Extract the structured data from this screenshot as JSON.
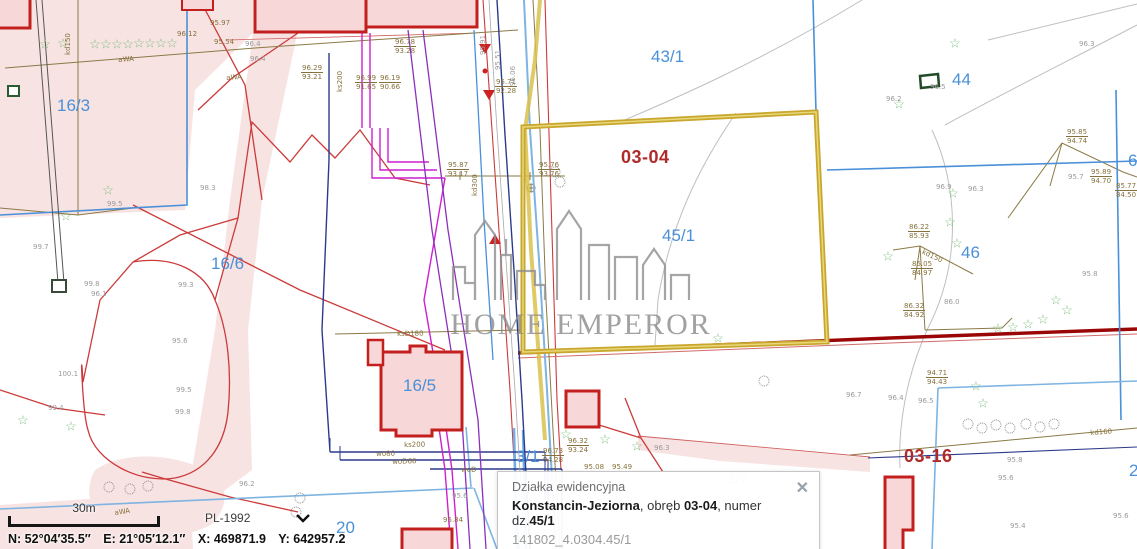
{
  "watermark": {
    "text": "HOME EMPEROR",
    "logo": "city-skyline-icon"
  },
  "selection": {
    "parcel": "45/1",
    "color": "#c9a62c"
  },
  "colors": {
    "parcel_label": "#4a90d9",
    "district_label": "#b02a2a",
    "link": "#3a6fd0"
  },
  "popup": {
    "title": "Działka ewidencyjna",
    "line_segments": [
      {
        "t": "Konstancin-Jeziorna",
        "b": true
      },
      {
        "t": ", obręb ",
        "b": false
      },
      {
        "t": "03-04",
        "b": true
      },
      {
        "t": ", numer dz.",
        "b": false
      },
      {
        "t": "45/1",
        "b": true
      }
    ],
    "id": "141802_4.0304.45/1",
    "links": [
      "Zbliż do obiektu",
      "Szczegóły (I)",
      "Inne"
    ],
    "close_icon": "✕"
  },
  "footer": {
    "scale_label": "30m",
    "crs": "PL-1992",
    "coords": {
      "n": "N: 52°04′35.5″",
      "e": "E: 21°05′12.1″",
      "x": "X: 469871.9",
      "y": "Y: 642957.2"
    }
  },
  "map": {
    "star_glyph": "☆",
    "labels": [
      {
        "t": "16/3",
        "x": 57,
        "y": 96,
        "c": "parcel"
      },
      {
        "t": "16/6",
        "x": 211,
        "y": 254,
        "c": "parcel"
      },
      {
        "t": "16/5",
        "x": 403,
        "y": 376,
        "c": "parcel"
      },
      {
        "t": "43/1",
        "x": 651,
        "y": 47,
        "c": "parcel"
      },
      {
        "t": "44",
        "x": 952,
        "y": 70,
        "c": "parcel"
      },
      {
        "t": "45/1",
        "x": 662,
        "y": 226,
        "c": "parcel"
      },
      {
        "t": "46",
        "x": 961,
        "y": 243,
        "c": "parcel"
      },
      {
        "t": "20",
        "x": 336,
        "y": 518,
        "c": "parcel"
      },
      {
        "t": "3/1",
        "x": 516,
        "y": 447,
        "c": "parcel"
      },
      {
        "t": "2/7",
        "x": 727,
        "y": 470,
        "c": "parcel-light"
      },
      {
        "t": "6",
        "x": 1128,
        "y": 151,
        "c": "parcel"
      },
      {
        "t": "2",
        "x": 1129,
        "y": 461,
        "c": "parcel"
      },
      {
        "t": "03-04",
        "x": 621,
        "y": 147,
        "c": "district"
      },
      {
        "t": "03-16",
        "x": 904,
        "y": 446,
        "c": "district"
      },
      {
        "t": "95.85",
        "t2": "94.74",
        "x": 1066,
        "y": 128,
        "c": "elev"
      },
      {
        "t": "95.89",
        "t2": "94.70",
        "x": 1090,
        "y": 168,
        "c": "elev"
      },
      {
        "t": "85.77",
        "t2": "84.50",
        "x": 1115,
        "y": 182,
        "c": "elev"
      },
      {
        "t": "86.22",
        "t2": "85.93",
        "x": 908,
        "y": 223,
        "c": "elev"
      },
      {
        "t": "85.05",
        "t2": "84.97",
        "x": 911,
        "y": 260,
        "c": "elev"
      },
      {
        "t": "86.32",
        "t2": "84.92",
        "x": 903,
        "y": 302,
        "c": "elev"
      },
      {
        "t": "95.87",
        "t2": "93.17",
        "x": 447,
        "y": 161,
        "c": "elev"
      },
      {
        "t": "95.76",
        "t2": "93.76",
        "x": 538,
        "y": 161,
        "c": "elev"
      },
      {
        "t": "95.71",
        "t2": "92.28",
        "x": 495,
        "y": 78,
        "c": "elev"
      },
      {
        "t": "96.78",
        "t2": "93.28",
        "x": 394,
        "y": 38,
        "c": "elev"
      },
      {
        "t": "96.29",
        "t2": "93.21",
        "x": 301,
        "y": 64,
        "c": "elev"
      },
      {
        "t": "96.99",
        "t2": "91.65",
        "x": 355,
        "y": 74,
        "c": "elev"
      },
      {
        "t": "96.19",
        "t2": "90.66",
        "x": 379,
        "y": 74,
        "c": "elev"
      },
      {
        "t": "96.32",
        "t2": "93.24",
        "x": 567,
        "y": 437,
        "c": "elev"
      },
      {
        "t": "96.73",
        "t2": "94.28",
        "x": 542,
        "y": 447,
        "c": "elev"
      },
      {
        "t": "94.71",
        "t2": "94.43",
        "x": 926,
        "y": 369,
        "c": "elev"
      },
      {
        "t": "96.12",
        "x": 177,
        "y": 30,
        "c": "elev"
      },
      {
        "t": "95.54",
        "x": 214,
        "y": 38,
        "c": "elev"
      },
      {
        "t": "95.97",
        "x": 210,
        "y": 19,
        "c": "elev"
      },
      {
        "t": "95.84",
        "x": 443,
        "y": 516,
        "c": "elev"
      },
      {
        "t": "95.08",
        "x": 584,
        "y": 463,
        "c": "elev"
      },
      {
        "t": "95.49",
        "x": 612,
        "y": 463,
        "c": "elev"
      },
      {
        "t": "99.7",
        "x": 33,
        "y": 243,
        "c": "pt"
      },
      {
        "t": "99.5",
        "x": 107,
        "y": 200,
        "c": "pt"
      },
      {
        "t": "98.3",
        "x": 200,
        "y": 184,
        "c": "pt"
      },
      {
        "t": "99.8",
        "x": 84,
        "y": 280,
        "c": "pt"
      },
      {
        "t": "99.3",
        "x": 178,
        "y": 281,
        "c": "pt"
      },
      {
        "t": "95.6",
        "x": 172,
        "y": 337,
        "c": "pt"
      },
      {
        "t": "100.1",
        "x": 58,
        "y": 370,
        "c": "pt"
      },
      {
        "t": "99.4",
        "x": 48,
        "y": 404,
        "c": "pt"
      },
      {
        "t": "99.5",
        "x": 176,
        "y": 386,
        "c": "pt"
      },
      {
        "t": "99.8",
        "x": 175,
        "y": 408,
        "c": "pt"
      },
      {
        "t": "96.2",
        "x": 239,
        "y": 480,
        "c": "pt"
      },
      {
        "t": "95.6",
        "x": 452,
        "y": 492,
        "c": "pt"
      },
      {
        "t": "96.4",
        "x": 245,
        "y": 40,
        "c": "pt"
      },
      {
        "t": "96.4",
        "x": 250,
        "y": 55,
        "c": "pt"
      },
      {
        "t": "96.1",
        "x": 91,
        "y": 290,
        "c": "pt"
      },
      {
        "t": "96.9",
        "x": 936,
        "y": 183,
        "c": "pt"
      },
      {
        "t": "96.3",
        "x": 968,
        "y": 185,
        "c": "pt"
      },
      {
        "t": "96.5",
        "x": 930,
        "y": 83,
        "c": "pt"
      },
      {
        "t": "96.3",
        "x": 1079,
        "y": 40,
        "c": "pt"
      },
      {
        "t": "96.2",
        "x": 886,
        "y": 95,
        "c": "pt"
      },
      {
        "t": "95.7",
        "x": 1068,
        "y": 173,
        "c": "pt"
      },
      {
        "t": "95.8",
        "x": 1082,
        "y": 270,
        "c": "pt"
      },
      {
        "t": "86.0",
        "x": 944,
        "y": 298,
        "c": "pt"
      },
      {
        "t": "95.8",
        "x": 1007,
        "y": 456,
        "c": "pt"
      },
      {
        "t": "95.6",
        "x": 998,
        "y": 474,
        "c": "pt"
      },
      {
        "t": "95.4",
        "x": 1010,
        "y": 522,
        "c": "pt"
      },
      {
        "t": "95.6",
        "x": 1113,
        "y": 512,
        "c": "pt"
      },
      {
        "t": "96.4",
        "x": 888,
        "y": 394,
        "c": "pt"
      },
      {
        "t": "96.5",
        "x": 918,
        "y": 397,
        "c": "pt"
      },
      {
        "t": "96.7",
        "x": 846,
        "y": 391,
        "c": "pt"
      },
      {
        "t": "96.3",
        "x": 654,
        "y": 444,
        "c": "pt"
      },
      {
        "t": "aWA",
        "x": 118,
        "y": 56,
        "c": "ut",
        "r": -4
      },
      {
        "t": "aWA",
        "x": 226,
        "y": 74,
        "c": "ut",
        "r": -4
      },
      {
        "t": "aWA",
        "x": 114,
        "y": 509,
        "c": "ut",
        "r": -8
      },
      {
        "t": "kd150",
        "x": 64,
        "y": 55,
        "c": "ut",
        "r": -90
      },
      {
        "t": "ks200",
        "x": 336,
        "y": 92,
        "c": "ut",
        "r": -90
      },
      {
        "t": "kd300",
        "x": 471,
        "y": 196,
        "c": "ut",
        "r": -90
      },
      {
        "t": "95.91",
        "x": 479,
        "y": 55,
        "c": "pt",
        "r": -90
      },
      {
        "t": "95.51",
        "x": 494,
        "y": 70,
        "c": "pt",
        "r": -90
      },
      {
        "t": "96.06",
        "x": 509,
        "y": 86,
        "c": "pt",
        "r": -90
      },
      {
        "t": "ksD180",
        "x": 397,
        "y": 330,
        "c": "ut",
        "r": -1
      },
      {
        "t": "ks200",
        "x": 404,
        "y": 441,
        "c": "ut",
        "r": -1
      },
      {
        "t": "wo80",
        "x": 376,
        "y": 450,
        "c": "ut",
        "r": -1
      },
      {
        "t": "woD66",
        "x": 392,
        "y": 458,
        "c": "ut",
        "r": -2
      },
      {
        "t": "woD",
        "x": 461,
        "y": 466,
        "c": "ut",
        "r": -1
      },
      {
        "t": "kd160",
        "x": 1090,
        "y": 429,
        "c": "ut",
        "r": -4
      },
      {
        "t": "kd150",
        "x": 924,
        "y": 248,
        "c": "ut",
        "r": 25
      }
    ],
    "stars": [
      [
        45,
        44
      ],
      [
        63,
        43
      ],
      [
        95,
        44
      ],
      [
        106,
        44
      ],
      [
        117,
        44
      ],
      [
        128,
        44
      ],
      [
        139,
        43
      ],
      [
        150,
        43
      ],
      [
        161,
        43
      ],
      [
        172,
        43
      ],
      [
        108,
        190
      ],
      [
        66,
        216
      ],
      [
        23,
        420
      ],
      [
        71,
        426
      ],
      [
        955,
        43
      ],
      [
        899,
        104
      ],
      [
        953,
        193
      ],
      [
        950,
        222
      ],
      [
        957,
        243
      ],
      [
        888,
        256
      ],
      [
        998,
        328
      ],
      [
        1013,
        327
      ],
      [
        1028,
        324
      ],
      [
        1043,
        319
      ],
      [
        1056,
        300
      ],
      [
        1067,
        310
      ],
      [
        976,
        386
      ],
      [
        983,
        403
      ],
      [
        566,
        434
      ],
      [
        605,
        439
      ],
      [
        637,
        446
      ],
      [
        718,
        338
      ]
    ],
    "circles": [
      [
        109,
        487
      ],
      [
        130,
        489
      ],
      [
        148,
        486
      ],
      [
        968,
        424
      ],
      [
        982,
        428
      ],
      [
        996,
        425
      ],
      [
        1010,
        428
      ],
      [
        1026,
        424
      ],
      [
        1040,
        427
      ],
      [
        1054,
        424
      ],
      [
        555,
        172
      ],
      [
        560,
        182
      ],
      [
        300,
        498
      ],
      [
        296,
        512
      ],
      [
        764,
        381
      ]
    ]
  }
}
